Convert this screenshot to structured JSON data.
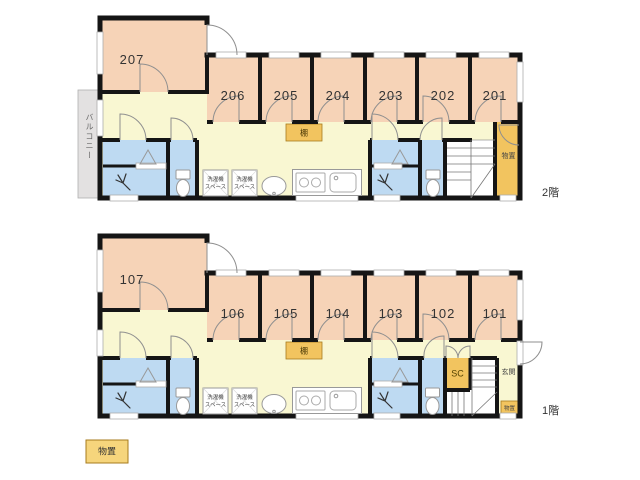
{
  "floor2": {
    "floor_label": "2階",
    "rooms": [
      "207",
      "206",
      "205",
      "204",
      "203",
      "202",
      "201"
    ],
    "balcony_label": "バルコニー",
    "shelf_label": "棚",
    "storage_label": "物置",
    "laundry_line1": "洗濯機",
    "laundry_line2": "スペース"
  },
  "floor1": {
    "floor_label": "1階",
    "rooms": [
      "107",
      "106",
      "105",
      "104",
      "103",
      "102",
      "101"
    ],
    "shelf_label": "棚",
    "shoe_closet_label": "SC",
    "entrance_label": "玄関",
    "entrance_storage_label": "物置",
    "laundry_line1": "洗濯機",
    "laundry_line2": "スペース"
  },
  "legend": {
    "storage_label": "物置"
  },
  "colors": {
    "room": "#f6d3b7",
    "common_area": "#f9f7d2",
    "wet_area": "#bedaf2",
    "storage": "#f2c45f",
    "balcony": "#e3e1e1",
    "wall": "#151515"
  }
}
